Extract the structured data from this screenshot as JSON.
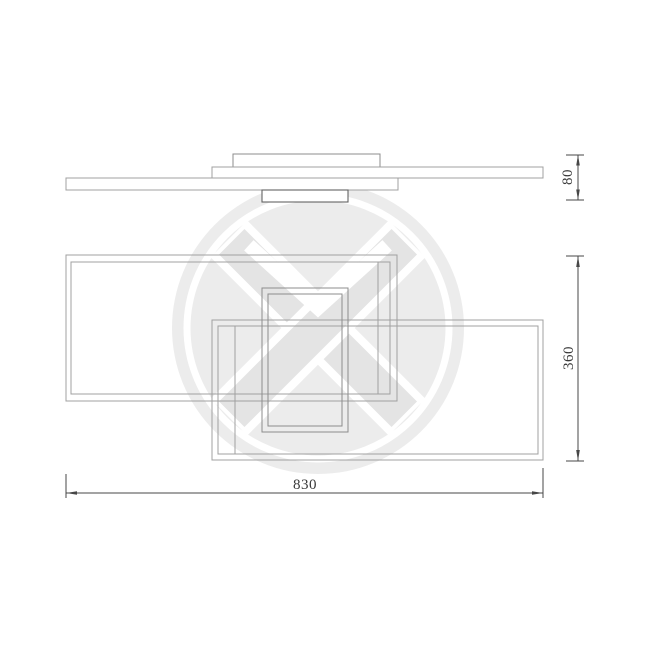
{
  "drawing": {
    "kind": "technical dimension drawing",
    "subject": "ceiling light fixture with three overlapping rectangular frames",
    "views": {
      "side_view": "stacked slim profile bars with ceiling canopy",
      "front_view": "three overlapping rectangular frames"
    }
  },
  "dimensions": {
    "fixture_depth": {
      "label": "80",
      "orientation": "vertical"
    },
    "fixture_height": {
      "label": "360",
      "orientation": "vertical"
    },
    "fixture_width": {
      "label": "830",
      "orientation": "horizontal"
    }
  },
  "icons": {
    "watermark": "circular-brand-logo-watermark"
  },
  "colors": {
    "line-light": "#a0a0a0",
    "line-mid": "#8c8c8c",
    "line-dark": "#636363",
    "dim": "#474747",
    "dim-text": "#383838",
    "wm-disc": "#ececec",
    "wm-ribbon": "#e4e4e4",
    "page-bg": "#ffffff"
  }
}
